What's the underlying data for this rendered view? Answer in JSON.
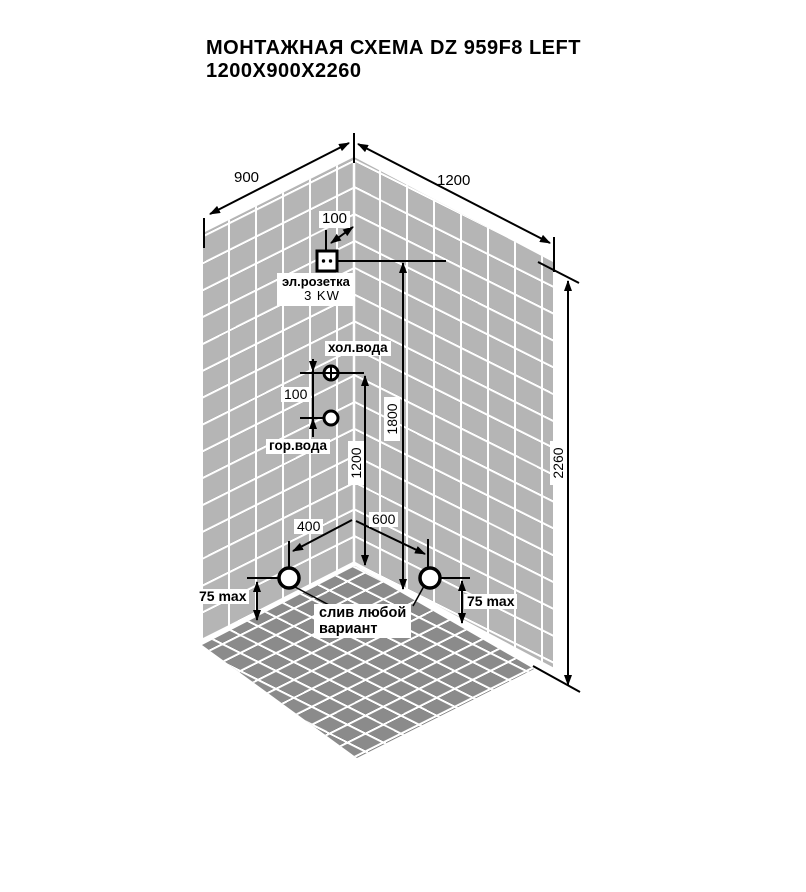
{
  "title": {
    "line1": "МОНТАЖНАЯ СХЕМА DZ 959F8 LEFT",
    "line2": "1200X900X2260"
  },
  "dims": {
    "left_wall_width": "900",
    "right_wall_width": "1200",
    "outlet_offset_from_corner": "100",
    "outlet_height": "1800",
    "water_height": "1200",
    "water_gap": "100",
    "drain_offset_left_wall": "400",
    "drain_offset_right_wall": "600",
    "cabin_height": "2260",
    "drain_max_left": "75 max",
    "drain_max_right": "75 max"
  },
  "labels": {
    "outlet_name": "эл.розетка",
    "outlet_power": "3 KW",
    "cold_water": "хол.вода",
    "hot_water": "гор.вода",
    "drain_note_line1": "слив любой",
    "drain_note_line2": "вариант"
  },
  "colors": {
    "wall_tile": "#b5b5b5",
    "floor_tile": "#8b8b8b",
    "grout": "#ffffff",
    "ink": "#000000"
  }
}
